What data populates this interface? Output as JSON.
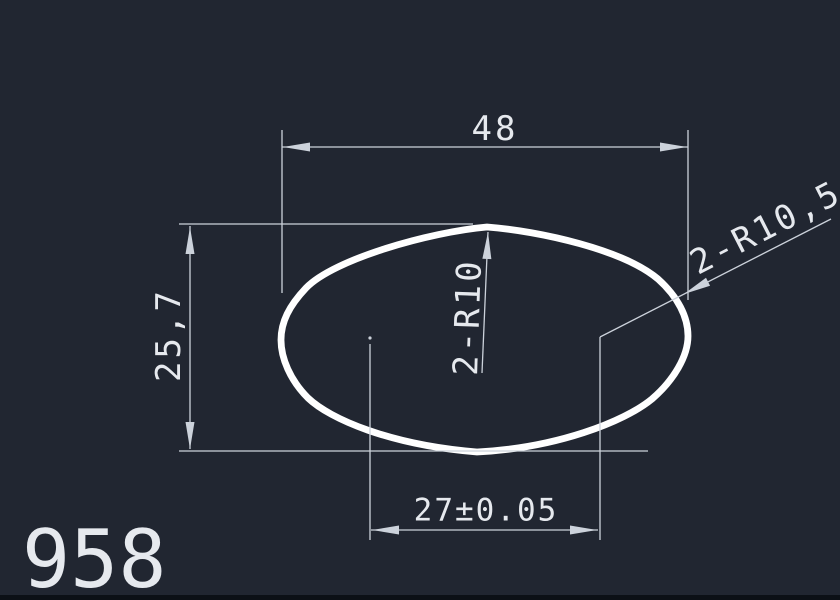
{
  "colors": {
    "background": "#212631",
    "thick_line": "#ffffff",
    "thin_line": "#ccd2db",
    "text": "#e6e9ee",
    "bottom_bar": "#0c1016"
  },
  "drawing": {
    "type": "cad-technical-drawing",
    "part_number": "958",
    "labels": {
      "width": "48",
      "height": "25,7",
      "inner_width": "27±0.05",
      "top_radius": "2-R10",
      "side_radius": "2-R10,5"
    }
  }
}
